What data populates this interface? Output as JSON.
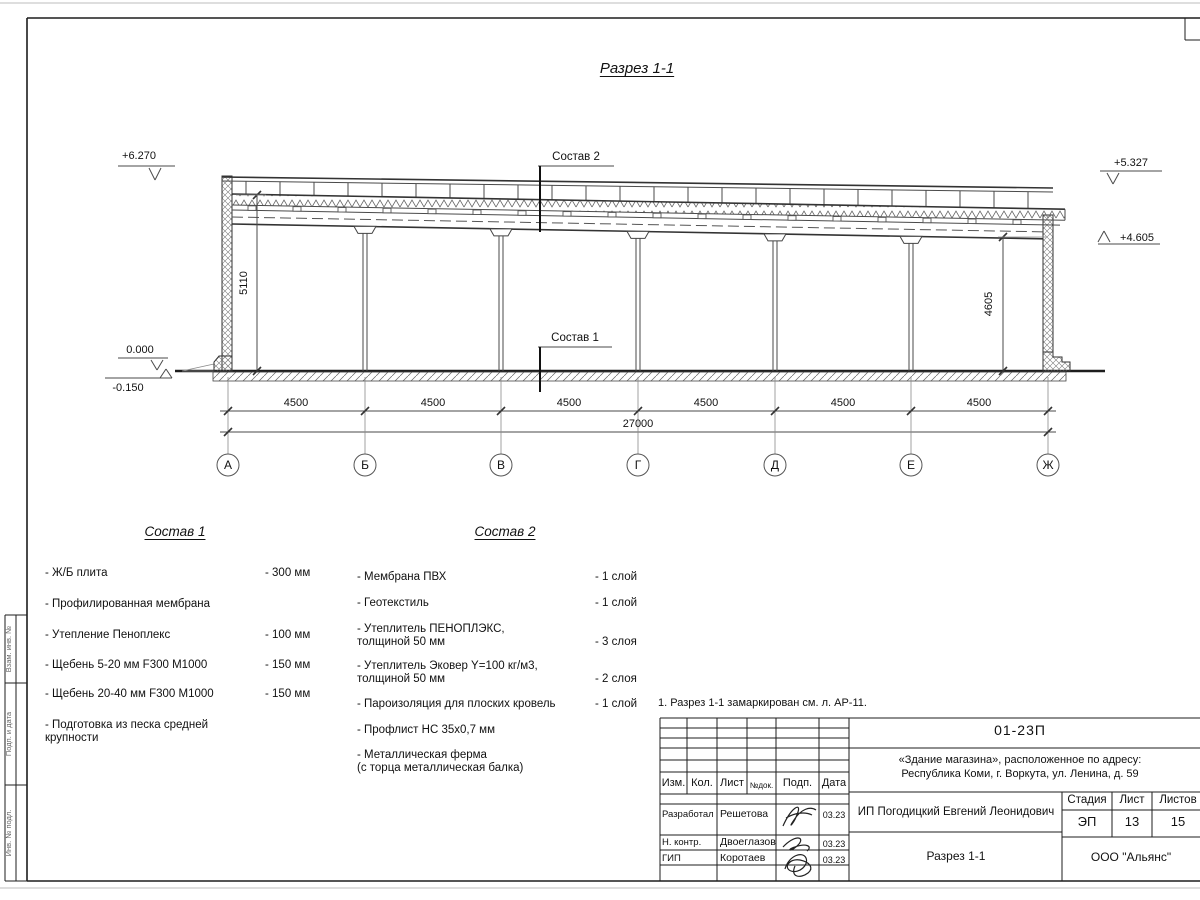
{
  "drawing": {
    "title": "Разрез 1-1",
    "labels": {
      "sostav1_ref": "Состав 1",
      "sostav2_ref": "Состав 2"
    },
    "elevations": {
      "left_top": "+6.270",
      "zero": "0.000",
      "minus": "-0.150",
      "right_top": "+5.327",
      "right_roof": "+4.605"
    },
    "dims": {
      "height_left": "5110",
      "height_right": "4605",
      "spans": [
        "4500",
        "4500",
        "4500",
        "4500",
        "4500",
        "4500"
      ],
      "total": "27000"
    },
    "axes": [
      "А",
      "Б",
      "В",
      "Г",
      "Д",
      "Е",
      "Ж"
    ]
  },
  "sostav1": {
    "title": "Состав 1",
    "items": [
      {
        "name": "- Ж/Б плита",
        "value": "- 300 мм"
      },
      {
        "name": "- Профилированная мембрана",
        "value": ""
      },
      {
        "name": "- Утепление Пеноплекс",
        "value": "- 100 мм"
      },
      {
        "name": "-  Щебень 5-20 мм F300 М1000",
        "value": "- 150 мм"
      },
      {
        "name": "-  Щебень 20-40 мм F300 М1000",
        "value": "- 150 мм"
      },
      {
        "name": "- Подготовка из песка средней\nкрупности",
        "value": ""
      }
    ]
  },
  "sostav2": {
    "title": "Состав 2",
    "items": [
      {
        "name": "- Мембрана ПВХ",
        "value": "- 1 слой"
      },
      {
        "name": "- Геотекстиль",
        "value": "- 1 слой"
      },
      {
        "name": "- Утеплитель ПЕНОПЛЭКС,\nтолщиной 50 мм",
        "value": "- 3 слоя"
      },
      {
        "name": "- Утеплитель Эковер Y=100 кг/м3,\nтолщиной 50 мм",
        "value": "- 2 слоя"
      },
      {
        "name": "- Пароизоляция для плоских кровель",
        "value": "- 1 слой"
      },
      {
        "name": "- Профлист НС 35х0,7 мм",
        "value": ""
      },
      {
        "name": "- Металлическая ферма\n(с торца металлическая балка)",
        "value": ""
      }
    ]
  },
  "note": "1. Разрез 1-1 замаркирован см. л. АР-11.",
  "titleblock": {
    "doc_number": "01-23П",
    "project": "«Здание магазина», расположенное по адресу:\nРеспублика Коми, г. Воркута, ул. Ленина, д. 59",
    "client": "ИП Погодицкий Евгений Леонидович",
    "sheet_title": "Разрез 1-1",
    "company": "ООО \"Альянс\"",
    "stage_label": "Стадия",
    "sheet_label": "Лист",
    "sheets_label": "Листов",
    "stage": "ЭП",
    "sheet": "13",
    "sheets": "15",
    "header": {
      "izm": "Изм.",
      "kol": "Кол.",
      "list": "Лист",
      "doc": "№док.",
      "podp": "Подп.",
      "data": "Дата"
    },
    "rows": [
      {
        "role": "Разработал",
        "name": "Решетова",
        "date": "03.23"
      },
      {
        "role": "Н. контр.",
        "name": "Двоеглазов",
        "date": "03.23"
      },
      {
        "role": "ГИП",
        "name": "Коротаев",
        "date": "03.23"
      }
    ]
  },
  "side_stamp": {
    "boxes": [
      "Взам. инв. №",
      "Подп. и дата",
      "Инв. № подл."
    ]
  }
}
